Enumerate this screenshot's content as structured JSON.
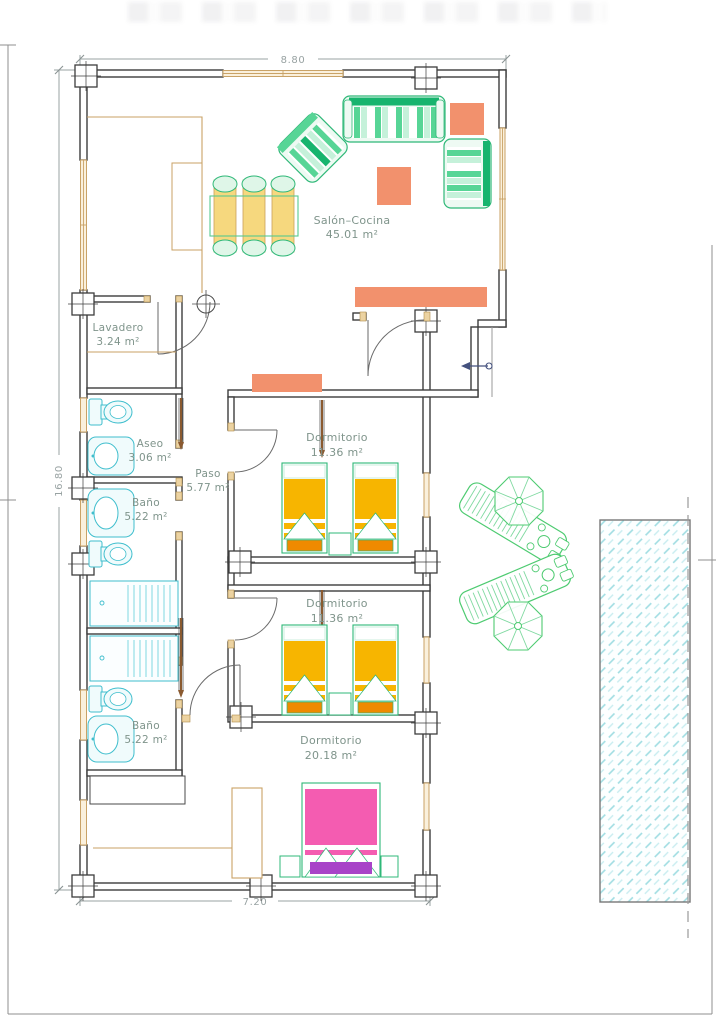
{
  "plan": {
    "dimensions": {
      "top": "8.80",
      "left": "16.80",
      "bottom": "7.20"
    },
    "rooms": {
      "salon": {
        "name": "Salón–Cocina",
        "area": "45.01 m²"
      },
      "lavadero": {
        "name": "Lavadero",
        "area": "3.24 m²"
      },
      "aseo": {
        "name": "Aseo",
        "area": "3.06 m²"
      },
      "bano1": {
        "name": "Baño",
        "area": "5.22 m²"
      },
      "paso": {
        "name": "Paso",
        "area": "5.77 m²"
      },
      "bano2": {
        "name": "Baño",
        "area": "5.22 m²"
      },
      "dorm1": {
        "name": "Dormitorio",
        "area": "11.36 m²"
      },
      "dorm2": {
        "name": "Dormitorio",
        "area": "11.36 m²"
      },
      "dorm3": {
        "name": "Dormitorio",
        "area": "20.18 m²"
      }
    },
    "colors": {
      "wall": "#3d3d3d",
      "window_frame": "#c9a266",
      "furniture_green": "#2fb878",
      "furniture_green_dark": "#17b46e",
      "furniture_mint": "#c5f1da",
      "salmon": "#f2916d",
      "chair_yellow": "#f6d87e",
      "bed_gold": "#f7b500",
      "bed_orange": "#ef8a00",
      "bed_pink": "#f45cb1",
      "bed_purple": "#a844c8",
      "fixture_cyan": "#3fbecd",
      "pool_hatch": "#9fdde2",
      "label_text": "#7f948b",
      "dimension_text": "#98a2a2"
    }
  }
}
